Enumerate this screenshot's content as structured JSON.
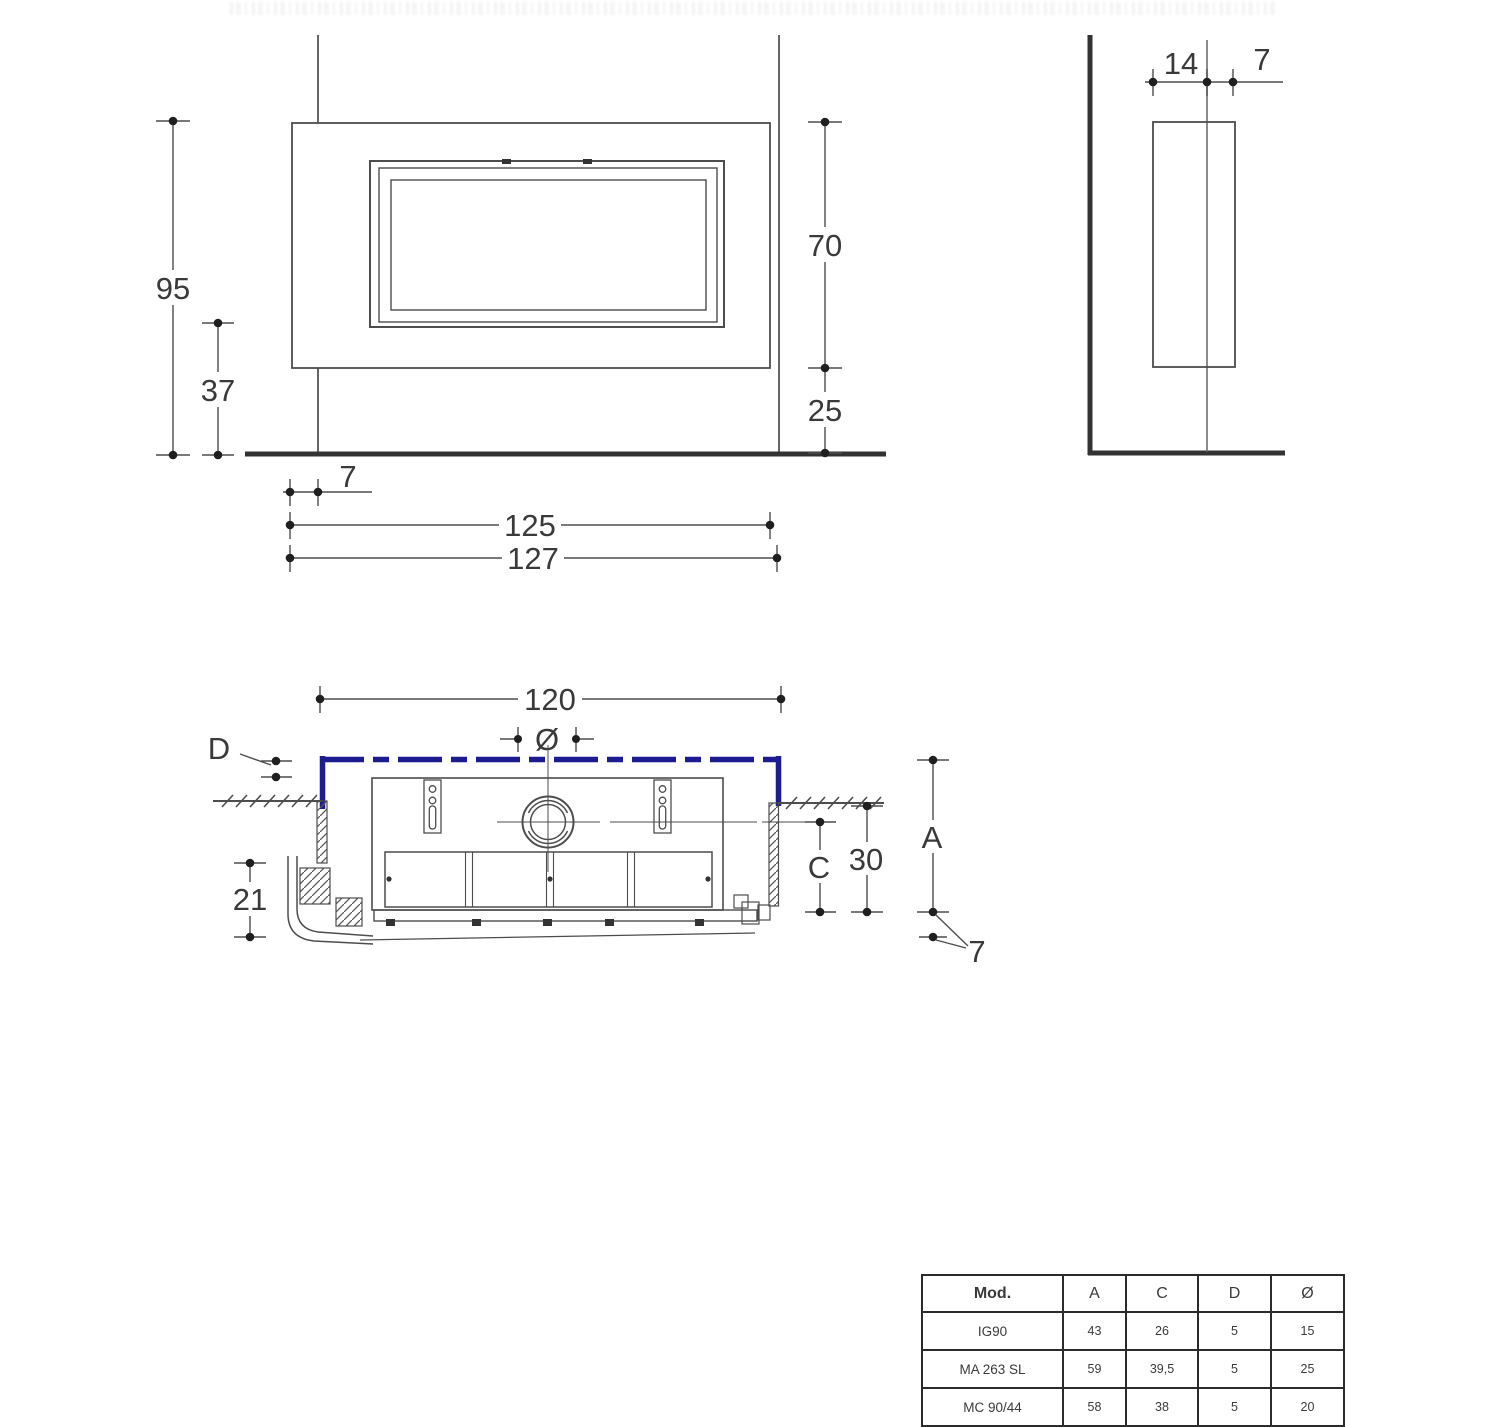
{
  "front_view": {
    "total_height": "95",
    "lower_height": "37",
    "opening_height": "70",
    "base_height": "25",
    "side_offset": "7",
    "inner_width": "125",
    "outer_width": "127"
  },
  "side_view": {
    "depth_wall": "14",
    "depth_front": "7"
  },
  "plan_view": {
    "niche_width": "120",
    "flue_diameter_symbol": "Ø",
    "gap_label": "D",
    "depth_a_label": "A",
    "depth_c_label": "C",
    "wall_depth": "30",
    "front_height": "21",
    "bottom_offset": "7"
  },
  "spec_table": {
    "headers": [
      "Mod.",
      "A",
      "C",
      "D",
      "Ø"
    ],
    "rows": [
      {
        "model": "IG90",
        "a": "43",
        "c": "26",
        "d": "5",
        "diameter": "15"
      },
      {
        "model": "MA 263 SL",
        "a": "59",
        "c": "39,5",
        "d": "5",
        "diameter": "25"
      },
      {
        "model": "MC 90/44",
        "a": "58",
        "c": "38",
        "d": "5",
        "diameter": "20"
      }
    ]
  },
  "colors": {
    "accent_blue": "#1c1c90",
    "line_dark": "#3c3c3c"
  }
}
